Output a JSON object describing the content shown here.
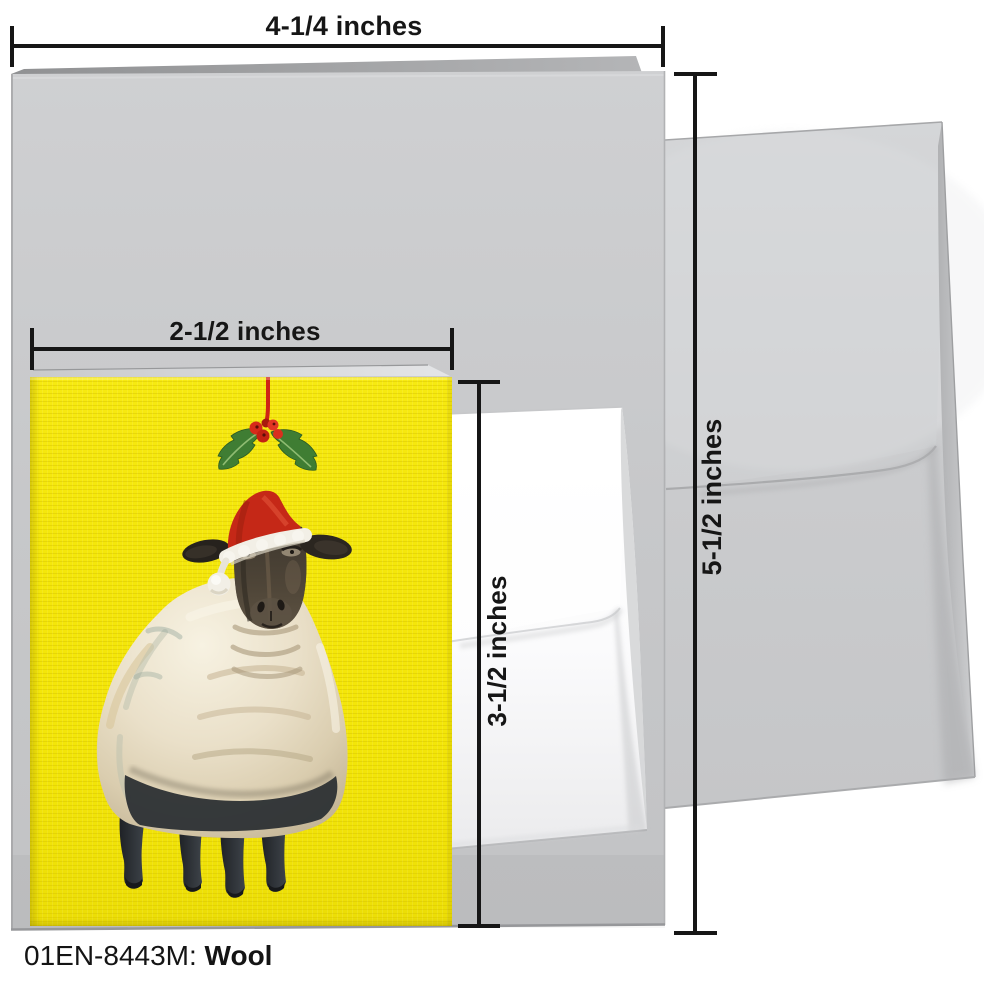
{
  "product": {
    "sku_label": "01EN-8443M:",
    "title": "Wool"
  },
  "dimensions": {
    "large_card_width": "4-1/4 inches",
    "large_card_height": "5-1/2 inches",
    "mini_card_width": "2-1/2 inches",
    "mini_card_height": "3-1/2 inches"
  },
  "colors": {
    "background": "#ffffff",
    "large_card_gray": "#c7c8ca",
    "envelope_gray": "#cbccce",
    "mini_envelope_white": "#fafafb",
    "mini_card_yellow": "#f4e70a",
    "santa_hat_red": "#c52817",
    "hat_trim_white": "#f2efe6",
    "holly_green": "#3f7d33",
    "berry_red": "#d62b1a",
    "sheep_wool_cream": "#e9dfc8",
    "sheep_face_dark": "#453d34",
    "annotation_black": "#161616"
  }
}
